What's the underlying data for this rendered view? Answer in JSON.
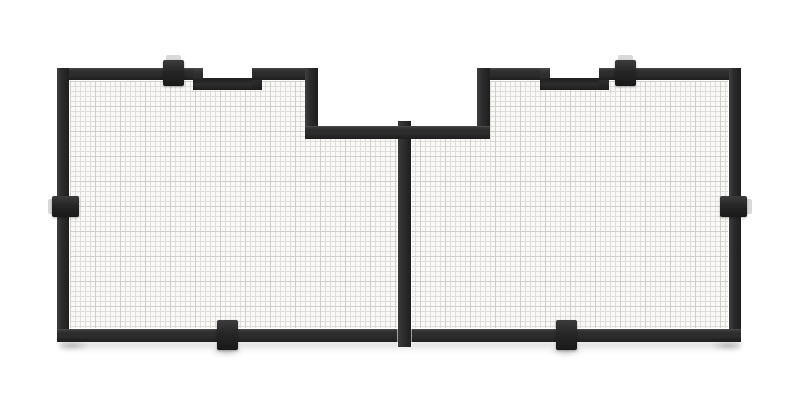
{
  "scene": {
    "subject": "Black metal-framed wire mesh screen panel with two mesh sections, a center divider bar, a recessed notch at top center, two shallow step recesses in the top rail, and six dark mounting clips",
    "style": "3D product render, front view, plain white studio background",
    "text_content": "none"
  },
  "colors": {
    "background": "#ffffff",
    "frame": "#2d2d2d",
    "frame-dark": "#1e1e1e",
    "frame-highlight": "#404040",
    "clip": "#262626",
    "backplate": "#d9d9d9",
    "mesh-bg": "#faf9f7",
    "mesh-line": "#deddda",
    "mesh-line-heavy": "#cfcec9"
  },
  "parts": [
    {
      "id": "wire-mesh",
      "label": "fine wire mesh infill"
    },
    {
      "id": "frame-top-rail",
      "label": "top frame rail with two stepped recesses"
    },
    {
      "id": "center-notch",
      "label": "recessed cut-out at top center"
    },
    {
      "id": "center-divider-bar",
      "label": "vertical divider between the two mesh sections"
    },
    {
      "id": "frame-side-rails",
      "label": "left and right frame rails"
    },
    {
      "id": "frame-bottom-rail",
      "label": "bottom frame rail"
    },
    {
      "id": "mounting-clips",
      "label": "six black mounting clips: two top, two side, two bottom"
    },
    {
      "id": "ground-shadow",
      "label": "soft shadow beneath the panel"
    }
  ]
}
